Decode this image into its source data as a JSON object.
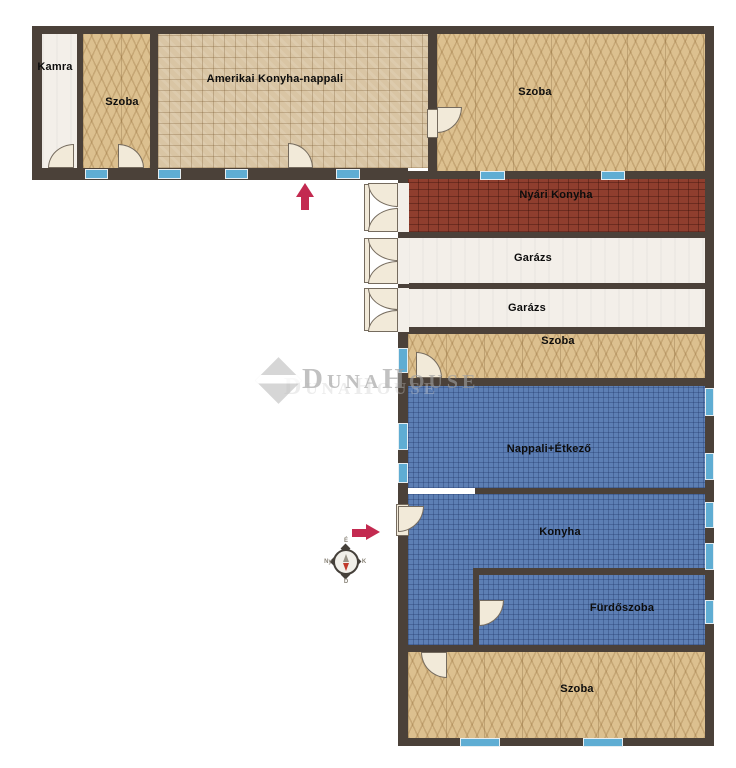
{
  "rooms": {
    "kamra": {
      "label": "Kamra"
    },
    "szoba_left": {
      "label": "Szoba"
    },
    "amerikai": {
      "label": "Amerikai Konyha-nappali"
    },
    "szoba_top_right": {
      "label": "Szoba"
    },
    "nyari_konyha": {
      "label": "Nyári Konyha"
    },
    "garazs_1": {
      "label": "Garázs"
    },
    "garazs_2": {
      "label": "Garázs"
    },
    "szoba_strip": {
      "label": "Szoba"
    },
    "nappali": {
      "label": "Nappali+Étkező"
    },
    "konyha": {
      "label": "Konyha"
    },
    "furdoszoba": {
      "label": "Fürdőszoba"
    },
    "szoba_bottom": {
      "label": "Szoba"
    }
  },
  "compass": {
    "north": "É",
    "east": "K",
    "south": "D",
    "west": "Ny"
  },
  "watermark": {
    "text": "DunaHouse"
  },
  "colors": {
    "wall": "#4b4139",
    "herringbone": "#dcc08f",
    "tile": "#d9c5a4",
    "brick": "#8f3e2e",
    "white_floor": "#f3efe9",
    "blue_floor": "#5d7fb4",
    "window": "#5fadd3",
    "door": "#f2ead9",
    "entrance_arrow": "#c32a50",
    "watermark_gray": "#ababab"
  }
}
